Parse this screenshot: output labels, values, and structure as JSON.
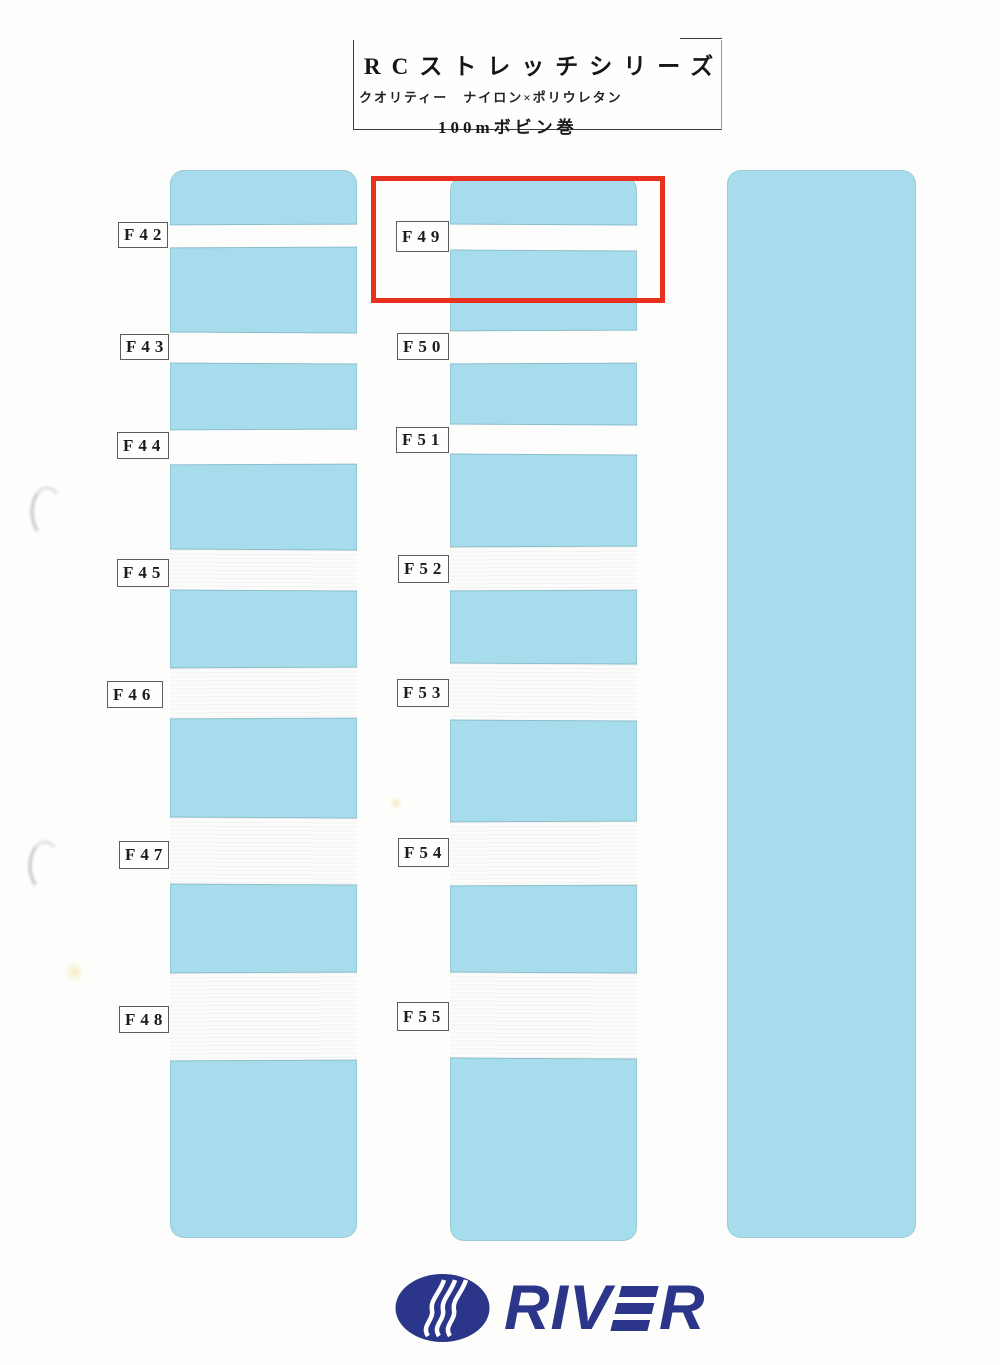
{
  "title_box": {
    "line1": "RCストレッチシリーズ",
    "line2": "クオリティー　ナイロン×ポリウレタン",
    "line3": "100mボビン巻"
  },
  "samples": {
    "left": [
      {
        "label": "F42"
      },
      {
        "label": "F43"
      },
      {
        "label": "F44"
      },
      {
        "label": "F45"
      },
      {
        "label": "F46"
      },
      {
        "label": "F47"
      },
      {
        "label": "F48"
      }
    ],
    "mid": [
      {
        "label": "F49"
      },
      {
        "label": "F50"
      },
      {
        "label": "F51"
      },
      {
        "label": "F52"
      },
      {
        "label": "F53"
      },
      {
        "label": "F54"
      },
      {
        "label": "F55"
      }
    ]
  },
  "highlight": {
    "highlighted_label": "F49",
    "color": "#e8301f"
  },
  "logo": {
    "full": "RIVER",
    "text_left": "RIV",
    "text_right": "R",
    "color": "#2b3589"
  },
  "colors": {
    "card_blue": "#a6dcec",
    "tape_white": "#fdfdfc",
    "highlight_red": "#e8301f",
    "logo_navy": "#2b3589"
  }
}
